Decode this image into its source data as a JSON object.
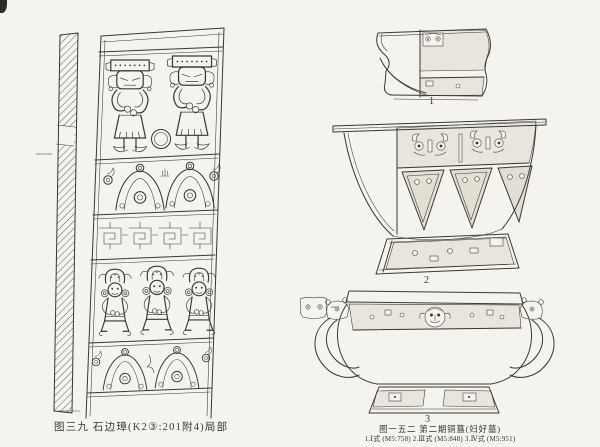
{
  "colors": {
    "paper": "#f5f3ee",
    "ink": "#3a3734"
  },
  "left_figure": {
    "caption": "图三九  石边璋(K2③:201附4)局部",
    "subject": "engraved stone/jade zhang blade with standing and kneeling figures, mountain motifs and meander band"
  },
  "right_figure": {
    "numbers": [
      "1",
      "2",
      "3"
    ],
    "caption": "图一五二  第二期铜簋(妇好墓)",
    "subcaption": "1.Ⅰ式 (M5:758)  2.Ⅲ式 (M5:848)  3.Ⅳ式 (M5:951)",
    "subject": "three bronze gui vessels shown half in profile, half with decorated surface"
  }
}
